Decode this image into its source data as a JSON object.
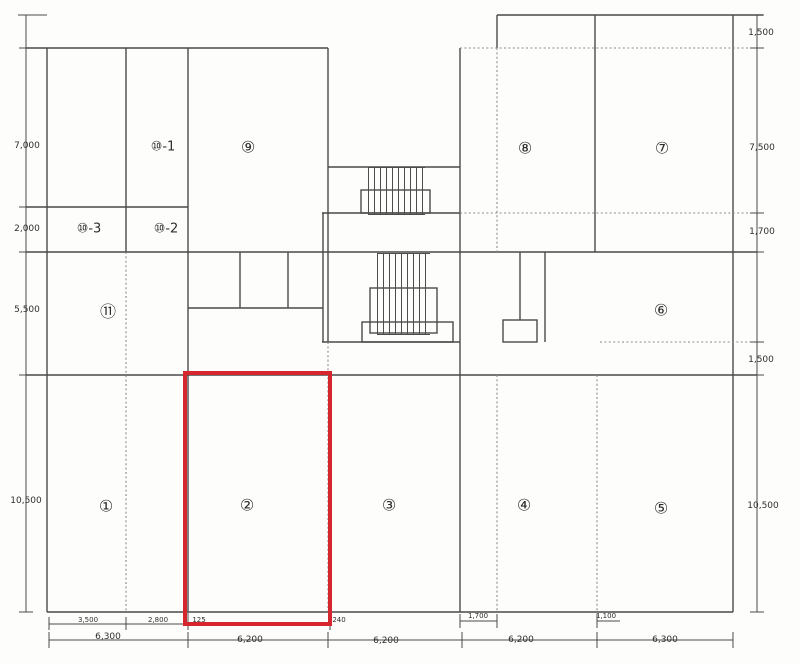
{
  "title": "floor-plan",
  "highlight": {
    "room": "②",
    "color": "#d4262c",
    "x": 183,
    "y": 371,
    "w": 141,
    "h": 247
  },
  "rooms": [
    {
      "id": "1",
      "label": "①",
      "x": 106,
      "y": 506,
      "size": "normal"
    },
    {
      "id": "2",
      "label": "②",
      "x": 247,
      "y": 505,
      "size": "normal"
    },
    {
      "id": "3",
      "label": "③",
      "x": 389,
      "y": 505,
      "size": "normal"
    },
    {
      "id": "4",
      "label": "④",
      "x": 524,
      "y": 505,
      "size": "normal"
    },
    {
      "id": "5",
      "label": "⑤",
      "x": 661,
      "y": 508,
      "size": "normal"
    },
    {
      "id": "6",
      "label": "⑥",
      "x": 661,
      "y": 310,
      "size": "normal"
    },
    {
      "id": "7",
      "label": "⑦",
      "x": 662,
      "y": 148,
      "size": "normal"
    },
    {
      "id": "8",
      "label": "⑧",
      "x": 525,
      "y": 148,
      "size": "normal"
    },
    {
      "id": "9",
      "label": "⑨",
      "x": 248,
      "y": 147,
      "size": "normal"
    },
    {
      "id": "10-1",
      "label": "⑩-1",
      "x": 163,
      "y": 147,
      "size": "small"
    },
    {
      "id": "10-2",
      "label": "⑩-2",
      "x": 166,
      "y": 229,
      "size": "small"
    },
    {
      "id": "10-3",
      "label": "⑩-3",
      "x": 89,
      "y": 229,
      "size": "small"
    },
    {
      "id": "11",
      "label": "⑪",
      "x": 108,
      "y": 310,
      "size": "normal"
    }
  ],
  "dimensions": {
    "left": [
      {
        "text": "7,000",
        "x": 27,
        "y": 146
      },
      {
        "text": "2,000",
        "x": 27,
        "y": 229
      },
      {
        "text": "5,500",
        "x": 27,
        "y": 310
      },
      {
        "text": "10,500",
        "x": 26,
        "y": 501
      }
    ],
    "right": [
      {
        "text": "1,500",
        "x": 761,
        "y": 33
      },
      {
        "text": "7,500",
        "x": 762,
        "y": 148
      },
      {
        "text": "1,700",
        "x": 762,
        "y": 232
      },
      {
        "text": "1,500",
        "x": 761,
        "y": 360
      },
      {
        "text": "10,500",
        "x": 763,
        "y": 506
      }
    ],
    "bottom_detail": [
      {
        "text": "3,500",
        "x": 88,
        "y": 620
      },
      {
        "text": "2,800",
        "x": 158,
        "y": 620
      },
      {
        "text": "125",
        "x": 199,
        "y": 620
      },
      {
        "text": "240",
        "x": 339,
        "y": 620
      },
      {
        "text": "1,700",
        "x": 478,
        "y": 616
      },
      {
        "text": "1,100",
        "x": 606,
        "y": 616
      }
    ],
    "bottom_main": [
      {
        "text": "6,300",
        "x": 108,
        "y": 637
      },
      {
        "text": "6,200",
        "x": 250,
        "y": 640
      },
      {
        "text": "6,200",
        "x": 386,
        "y": 641
      },
      {
        "text": "6,200",
        "x": 521,
        "y": 640
      },
      {
        "text": "6,300",
        "x": 665,
        "y": 640
      }
    ]
  }
}
